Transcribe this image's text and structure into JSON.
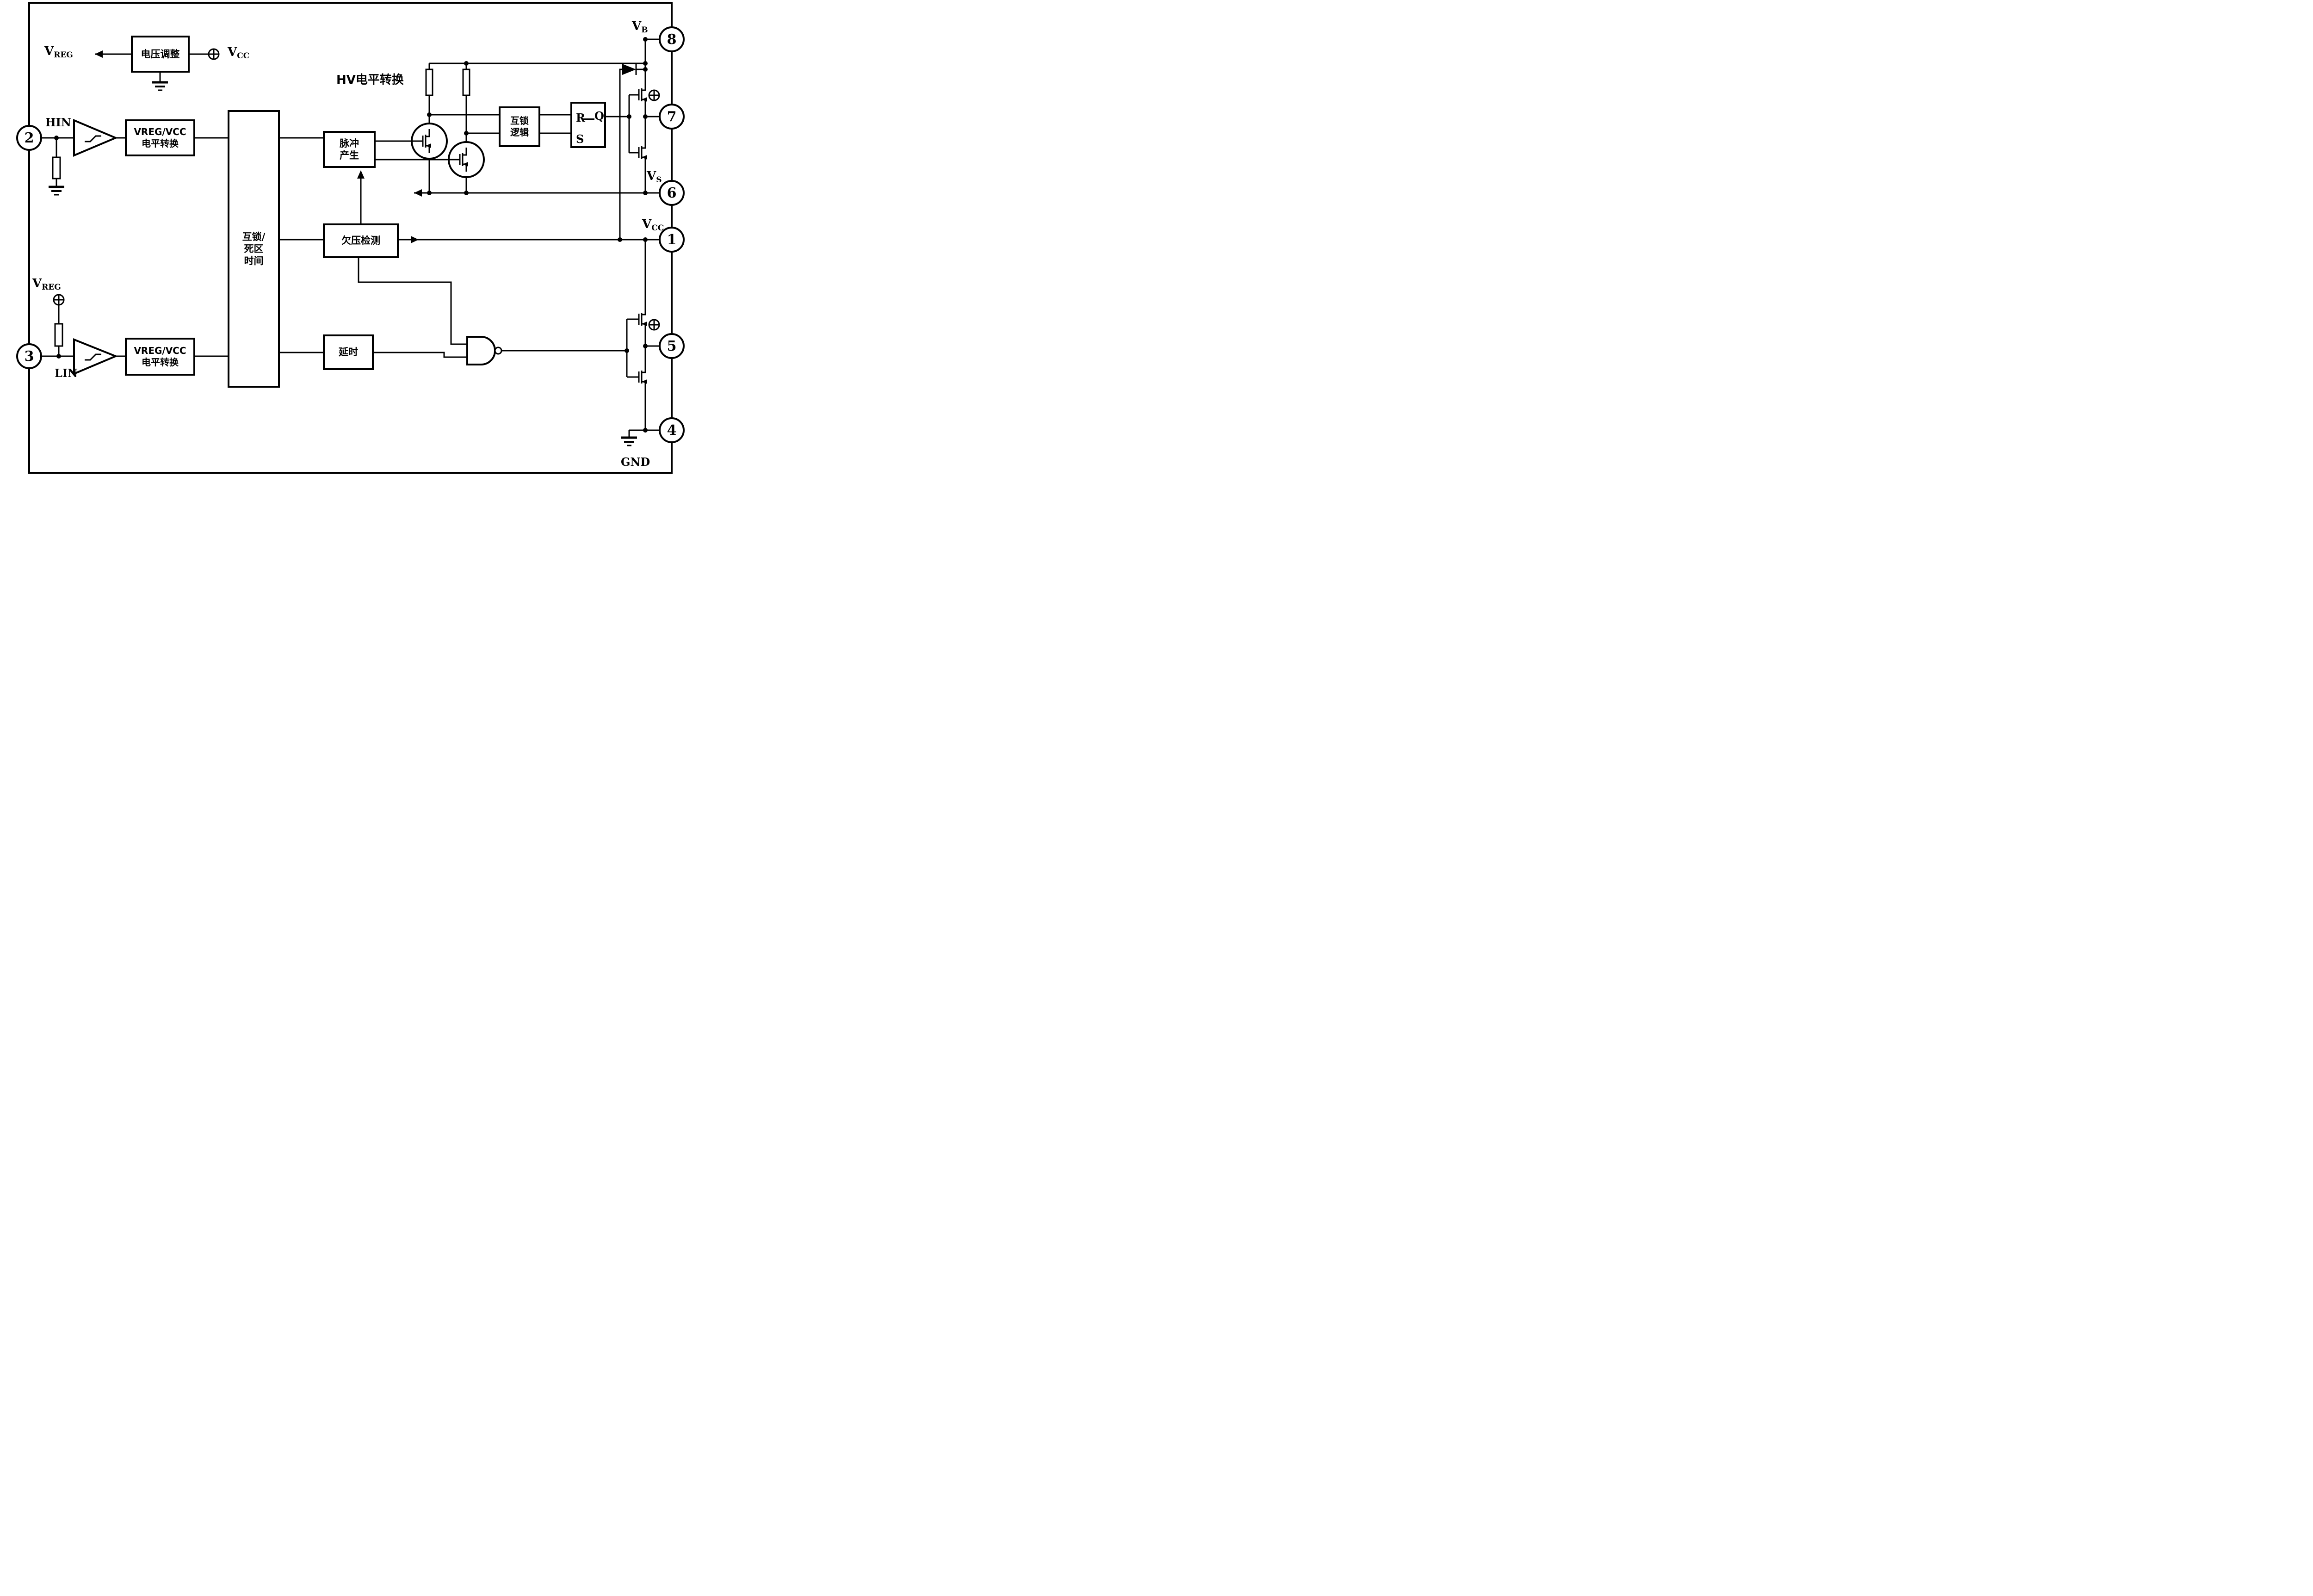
{
  "note_hv": "HV电平转换",
  "blocks": {
    "regulator": "电压调整",
    "ls_top": [
      "VREG/VCC",
      "电平转换"
    ],
    "ls_bot": [
      "VREG/VCC",
      "电平转换"
    ],
    "deadtime": [
      "互锁/",
      "死区",
      "时间"
    ],
    "pulse": [
      "脉冲",
      "产生"
    ],
    "ilock": [
      "互锁",
      "逻辑"
    ],
    "latch": {
      "r": "R",
      "q": "Q",
      "s": "S"
    },
    "uv": "欠压检测",
    "delay": "延时"
  },
  "rails": {
    "vreg": {
      "base": "V",
      "sub": "REG"
    },
    "vcc": {
      "base": "V",
      "sub": "CC"
    },
    "vb": {
      "base": "V",
      "sub": "B"
    },
    "vs": {
      "base": "V",
      "sub": "S"
    },
    "gnd": "GND",
    "hin": "HIN",
    "lin": "LIN"
  },
  "pins": {
    "p1": "1",
    "p2": "2",
    "p3": "3",
    "p4": "4",
    "p5": "5",
    "p6": "6",
    "p7": "7",
    "p8": "8"
  },
  "colors": {
    "line": "#000000",
    "background": "#ffffff"
  }
}
